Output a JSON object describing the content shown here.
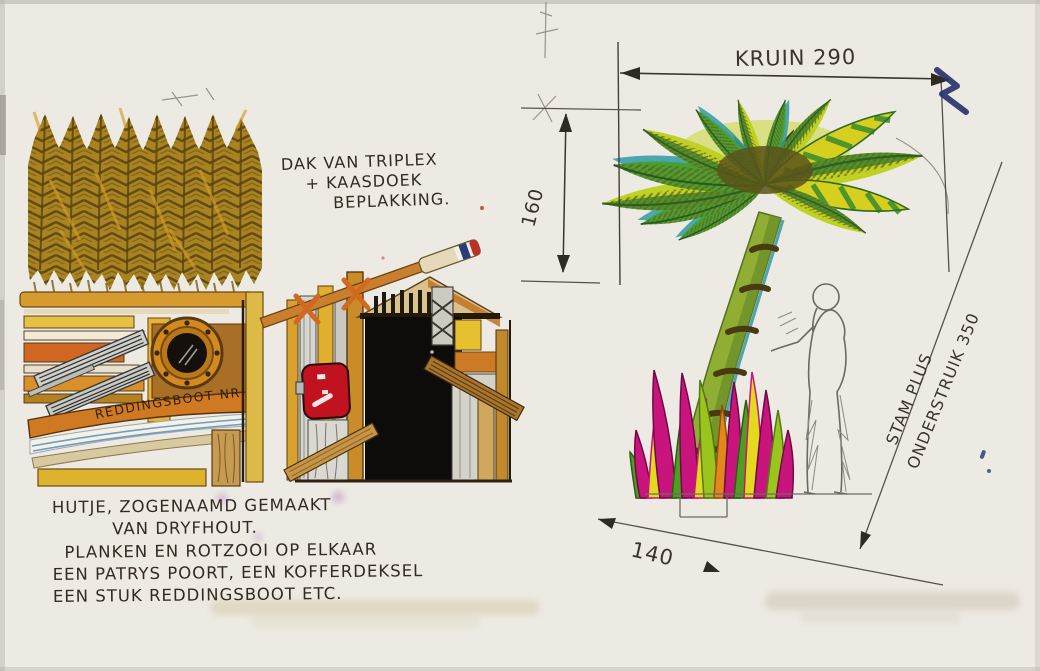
{
  "sketch": {
    "roof_note": {
      "line1": "DAK VAN TRIPLEX",
      "line2": "+ KAASDOEK",
      "line3": "BEPLAKKING."
    },
    "hut_plank_text": "REDDINGSBOOT NR 18",
    "caption": {
      "line1": "HUTJE, ZOGENAAMD GEMAAKT",
      "line2": "VAN DRYFHOUT.",
      "line3": "PLANKEN EN ROTZOOI OP ELKAAR",
      "line4": "EEN PATRYS POORT, EEN KOFFERDEKSEL",
      "line5": "EEN STUK REDDINGSBOOT ETC."
    },
    "dimensions": {
      "crown_width": "KRUIN 290",
      "crown_height": "160",
      "base_width": "140",
      "trunk_line1": "STAM PLUS",
      "trunk_line2": "ONDERSTRUIK 350"
    },
    "colors": {
      "paper": "#efece6",
      "ink": "#332b20",
      "pencil": "#6f6a62",
      "marker_blue": "#28336e",
      "palm_green": "#46a033",
      "palm_yellow_green": "#bfd122",
      "palm_teal": "#2e9aa8",
      "grass_magenta": "#c9147e",
      "wood_yellow": "#ddb22c",
      "wood_orange": "#cf6b22",
      "suitcase_red": "#c1121f",
      "flag_red": "#bd3026",
      "flag_blue": "#2a3c7c"
    }
  }
}
